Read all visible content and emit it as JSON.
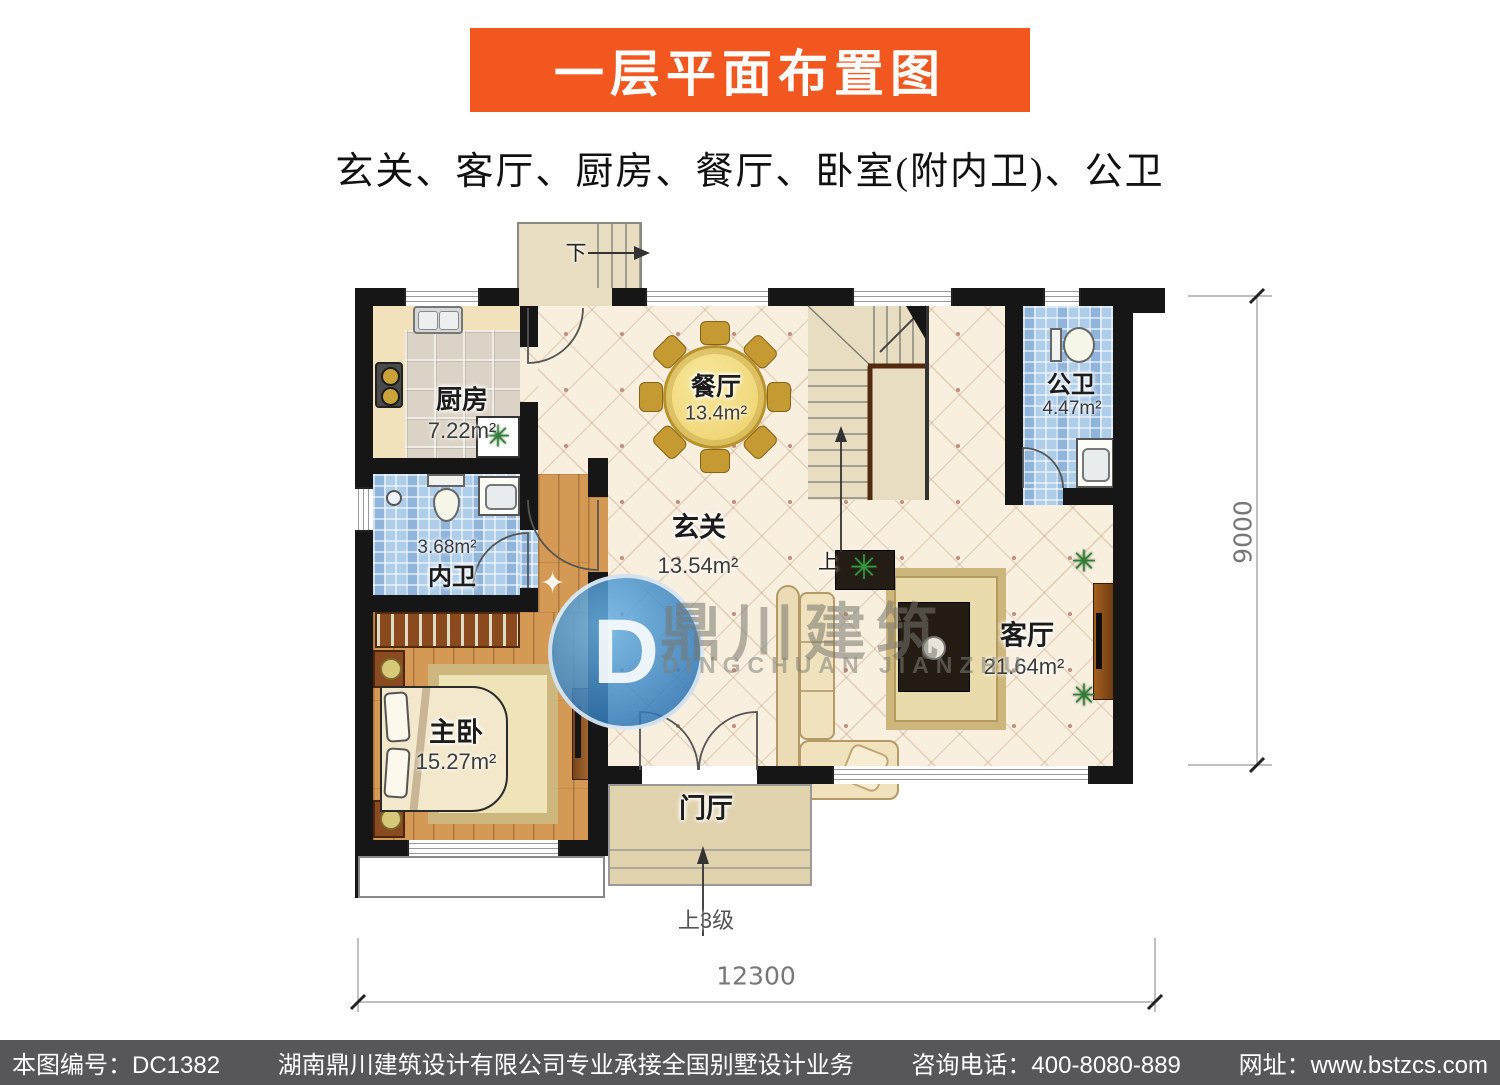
{
  "header": {
    "title": "一层平面布置图",
    "subtitle": "玄关、客厅、厨房、餐厅、卧室(附内卫)、公卫",
    "banner_color": "#f1571f"
  },
  "plan": {
    "rooms": {
      "kitchen": {
        "name": "厨房",
        "area": "7.22m²"
      },
      "dining": {
        "name": "餐厅",
        "area": "13.4m²"
      },
      "public_bath": {
        "name": "公卫",
        "area": "4.47m²"
      },
      "inner_bath": {
        "name": "内卫",
        "area": "3.68m²"
      },
      "foyer": {
        "name": "玄关",
        "area": "13.54m²"
      },
      "living": {
        "name": "客厅",
        "area": "21.64m²"
      },
      "master_bed": {
        "name": "主卧",
        "area": "15.27m²"
      },
      "entry_hall": {
        "name": "门厅"
      }
    },
    "stairs": {
      "down_label": "下",
      "up_label": "上",
      "entry_steps_label": "上3级"
    },
    "dimensions": {
      "width": "12300",
      "height": "9000"
    }
  },
  "watermark": {
    "cjk": "鼎川建筑",
    "latin": "DINGCHUAN JIANZHU",
    "logo_letter": "D",
    "star_icon": "✦",
    "brand_blue": "#2e86c8"
  },
  "icons": {
    "plant": "✳"
  },
  "footer": {
    "plan_no": "本图编号：DC1382",
    "company": "湖南鼎川建筑设计有限公司专业承接全国别墅设计业务",
    "phone": "咨询电话：400-8080-889",
    "website": "网址：www.bstzcs.com"
  }
}
